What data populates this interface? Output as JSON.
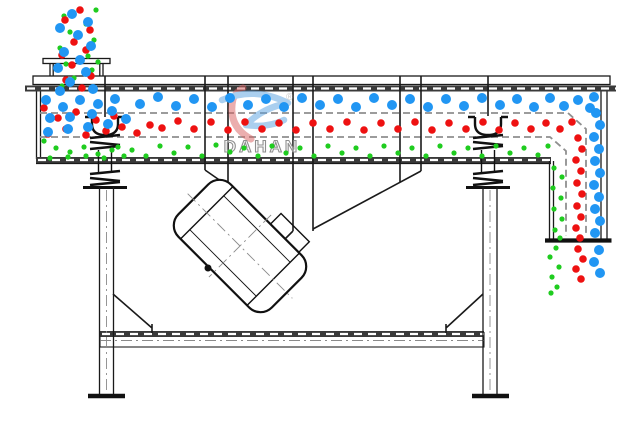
{
  "watermark": {
    "brand": "DAHAN",
    "registered_mark": "®"
  },
  "palette": {
    "particle_blue": "#2196F3",
    "particle_red": "#EE1111",
    "particle_green": "#1FCC1F",
    "line_dark": "#1a1a1a",
    "line_gray": "#8f8f8f",
    "logo_red": "#D96060",
    "logo_blue": "#58A0E0",
    "logo_gray": "#9a9a9a"
  },
  "particle_radii": {
    "blue": 5,
    "red": 3.8,
    "green": 2.6
  },
  "particles": {
    "blue": [
      [
        72,
        14
      ],
      [
        88,
        22
      ],
      [
        60,
        28
      ],
      [
        78,
        35
      ],
      [
        91,
        46
      ],
      [
        64,
        52
      ],
      [
        80,
        60
      ],
      [
        58,
        68
      ],
      [
        86,
        72
      ],
      [
        70,
        82
      ],
      [
        93,
        89
      ],
      [
        60,
        91
      ],
      [
        46,
        100
      ],
      [
        63,
        107
      ],
      [
        80,
        100
      ],
      [
        98,
        104
      ],
      [
        115,
        99
      ],
      [
        50,
        118
      ],
      [
        70,
        117
      ],
      [
        92,
        114
      ],
      [
        112,
        111
      ],
      [
        48,
        132
      ],
      [
        68,
        129
      ],
      [
        88,
        127
      ],
      [
        108,
        124
      ],
      [
        126,
        119
      ],
      [
        140,
        104
      ],
      [
        158,
        97
      ],
      [
        176,
        106
      ],
      [
        194,
        99
      ],
      [
        212,
        107
      ],
      [
        230,
        98
      ],
      [
        248,
        105
      ],
      [
        266,
        99
      ],
      [
        284,
        107
      ],
      [
        302,
        98
      ],
      [
        320,
        105
      ],
      [
        338,
        99
      ],
      [
        356,
        107
      ],
      [
        374,
        98
      ],
      [
        392,
        105
      ],
      [
        410,
        99
      ],
      [
        428,
        107
      ],
      [
        446,
        99
      ],
      [
        464,
        106
      ],
      [
        482,
        98
      ],
      [
        500,
        105
      ],
      [
        517,
        99
      ],
      [
        534,
        107
      ],
      [
        550,
        98
      ],
      [
        564,
        106
      ],
      [
        578,
        100
      ],
      [
        590,
        108
      ],
      [
        594,
        97
      ],
      [
        596,
        113
      ],
      [
        600,
        125
      ],
      [
        594,
        137
      ],
      [
        599,
        149
      ],
      [
        595,
        161
      ],
      [
        600,
        173
      ],
      [
        594,
        185
      ],
      [
        599,
        197
      ],
      [
        595,
        209
      ],
      [
        600,
        221
      ],
      [
        595,
        233
      ],
      [
        599,
        250
      ],
      [
        594,
        262
      ],
      [
        600,
        273
      ]
    ],
    "red": [
      [
        80,
        10
      ],
      [
        65,
        20
      ],
      [
        90,
        30
      ],
      [
        74,
        42
      ],
      [
        62,
        55
      ],
      [
        86,
        50
      ],
      [
        72,
        65
      ],
      [
        91,
        76
      ],
      [
        66,
        80
      ],
      [
        82,
        88
      ],
      [
        44,
        108
      ],
      [
        58,
        118
      ],
      [
        76,
        112
      ],
      [
        96,
        120
      ],
      [
        114,
        116
      ],
      [
        48,
        134
      ],
      [
        66,
        129
      ],
      [
        86,
        135
      ],
      [
        106,
        131
      ],
      [
        122,
        127
      ],
      [
        137,
        133
      ],
      [
        150,
        125
      ],
      [
        162,
        128
      ],
      [
        178,
        121
      ],
      [
        194,
        129
      ],
      [
        211,
        122
      ],
      [
        228,
        130
      ],
      [
        245,
        122
      ],
      [
        262,
        129
      ],
      [
        279,
        123
      ],
      [
        296,
        130
      ],
      [
        313,
        123
      ],
      [
        330,
        129
      ],
      [
        347,
        122
      ],
      [
        364,
        130
      ],
      [
        381,
        123
      ],
      [
        398,
        129
      ],
      [
        415,
        122
      ],
      [
        432,
        130
      ],
      [
        449,
        123
      ],
      [
        466,
        129
      ],
      [
        483,
        122
      ],
      [
        499,
        130
      ],
      [
        515,
        123
      ],
      [
        531,
        129
      ],
      [
        546,
        123
      ],
      [
        560,
        129
      ],
      [
        572,
        122
      ],
      [
        578,
        138
      ],
      [
        582,
        149
      ],
      [
        576,
        160
      ],
      [
        581,
        171
      ],
      [
        577,
        183
      ],
      [
        582,
        194
      ],
      [
        577,
        206
      ],
      [
        581,
        217
      ],
      [
        576,
        228
      ],
      [
        580,
        238
      ],
      [
        578,
        249
      ],
      [
        583,
        259
      ],
      [
        576,
        269
      ],
      [
        581,
        279
      ]
    ],
    "green": [
      [
        96,
        10
      ],
      [
        64,
        16
      ],
      [
        86,
        24
      ],
      [
        70,
        32
      ],
      [
        94,
        40
      ],
      [
        60,
        48
      ],
      [
        88,
        56
      ],
      [
        66,
        64
      ],
      [
        92,
        70
      ],
      [
        74,
        78
      ],
      [
        62,
        86
      ],
      [
        98,
        62
      ],
      [
        44,
        141
      ],
      [
        56,
        148
      ],
      [
        70,
        152
      ],
      [
        84,
        147
      ],
      [
        98,
        154
      ],
      [
        112,
        150
      ],
      [
        124,
        156
      ],
      [
        50,
        158
      ],
      [
        68,
        157
      ],
      [
        86,
        156
      ],
      [
        104,
        158
      ],
      [
        118,
        147
      ],
      [
        132,
        150
      ],
      [
        146,
        156
      ],
      [
        160,
        146
      ],
      [
        174,
        153
      ],
      [
        188,
        147
      ],
      [
        202,
        156
      ],
      [
        216,
        145
      ],
      [
        230,
        152
      ],
      [
        244,
        148
      ],
      [
        258,
        156
      ],
      [
        272,
        146
      ],
      [
        286,
        153
      ],
      [
        300,
        148
      ],
      [
        314,
        156
      ],
      [
        328,
        146
      ],
      [
        342,
        153
      ],
      [
        356,
        148
      ],
      [
        370,
        156
      ],
      [
        384,
        146
      ],
      [
        398,
        153
      ],
      [
        412,
        148
      ],
      [
        426,
        156
      ],
      [
        440,
        146
      ],
      [
        454,
        153
      ],
      [
        468,
        148
      ],
      [
        482,
        156
      ],
      [
        496,
        146
      ],
      [
        510,
        153
      ],
      [
        524,
        148
      ],
      [
        538,
        155
      ],
      [
        548,
        146
      ],
      [
        554,
        168
      ],
      [
        562,
        177
      ],
      [
        553,
        188
      ],
      [
        561,
        198
      ],
      [
        554,
        209
      ],
      [
        562,
        219
      ],
      [
        555,
        230
      ],
      [
        560,
        238
      ],
      [
        556,
        248
      ],
      [
        550,
        257
      ],
      [
        559,
        267
      ],
      [
        552,
        277
      ],
      [
        557,
        287
      ],
      [
        551,
        293
      ]
    ]
  }
}
